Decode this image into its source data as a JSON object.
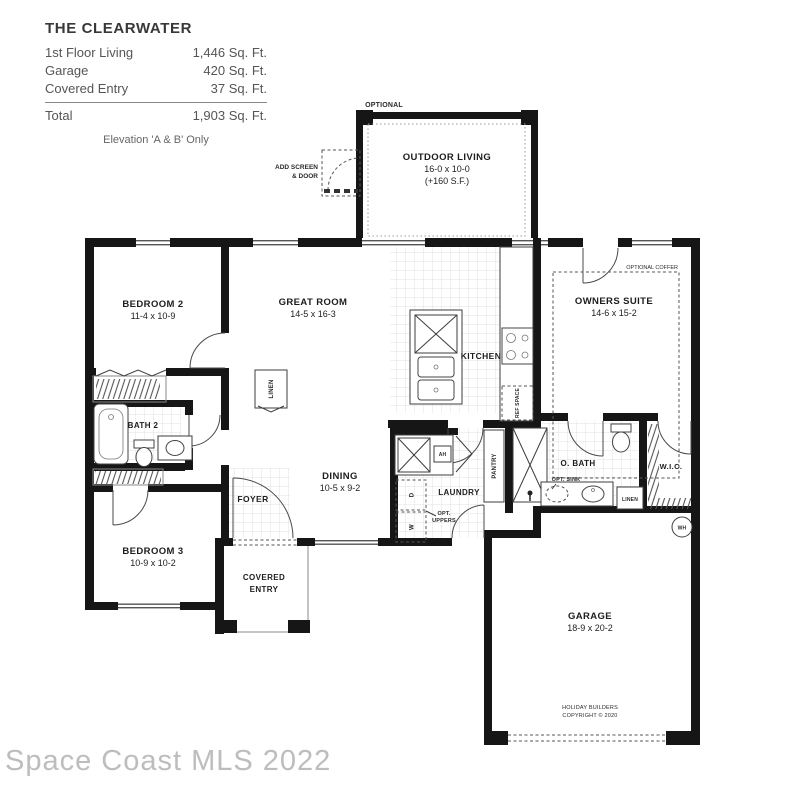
{
  "title_block": {
    "title": "THE CLEARWATER",
    "rows": [
      {
        "label": "1st Floor Living",
        "value": "1,446 Sq. Ft."
      },
      {
        "label": "Garage",
        "value": "420 Sq. Ft."
      },
      {
        "label": "Covered Entry",
        "value": "37 Sq. Ft."
      }
    ],
    "total": {
      "label": "Total",
      "value": "1,903 Sq. Ft."
    },
    "elevation_note": "Elevation 'A & B' Only"
  },
  "plan": {
    "optional_label": "OPTIONAL",
    "outdoor_living": {
      "name": "OUTDOOR LIVING",
      "dims": "16-0 x 10-0",
      "extra": "(+160 S.F.)"
    },
    "add_screen": {
      "line1": "ADD SCREEN",
      "line2": "& DOOR"
    },
    "rooms": {
      "bedroom2": {
        "name": "BEDROOM 2",
        "dims": "11-4 x 10-9"
      },
      "great_room": {
        "name": "GREAT ROOM",
        "dims": "14-5 x 16-3"
      },
      "owners_suite": {
        "name": "OWNERS SUITE",
        "dims": "14-6 x 15-2"
      },
      "kitchen": {
        "name": "KITCHEN"
      },
      "dining": {
        "name": "DINING",
        "dims": "10-5 x 9-2"
      },
      "bedroom3": {
        "name": "BEDROOM 3",
        "dims": "10-9 x 10-2"
      },
      "bath2": {
        "name": "BATH 2"
      },
      "obath": {
        "name": "O. BATH"
      },
      "wic": {
        "name": "W.I.C."
      },
      "laundry": {
        "name": "LAUNDRY"
      },
      "foyer": {
        "name": "FOYER"
      },
      "covered_entry": {
        "line1": "COVERED",
        "line2": "ENTRY"
      },
      "garage": {
        "name": "GARAGE",
        "dims": "18-9 x 20-2"
      }
    },
    "small_labels": {
      "optional_coffer": "OPTIONAL COFFER",
      "ref_space": "REF SPACE",
      "pantry": "PANTRY",
      "linen_hall": "LINEN",
      "linen_bath": "LINEN",
      "opt_sink": "OPT. SINK",
      "opt_uppers_line1": "OPT.",
      "opt_uppers_line2": "UPPERS",
      "washer": "W",
      "dryer": "D",
      "air_handler": "AH",
      "water_heater": "WH"
    },
    "copyright": {
      "line1": "HOLIDAY BUILDERS",
      "line2": "COPYRIGHT © 2020"
    }
  },
  "watermark": {
    "text": "Space Coast MLS 2022"
  }
}
